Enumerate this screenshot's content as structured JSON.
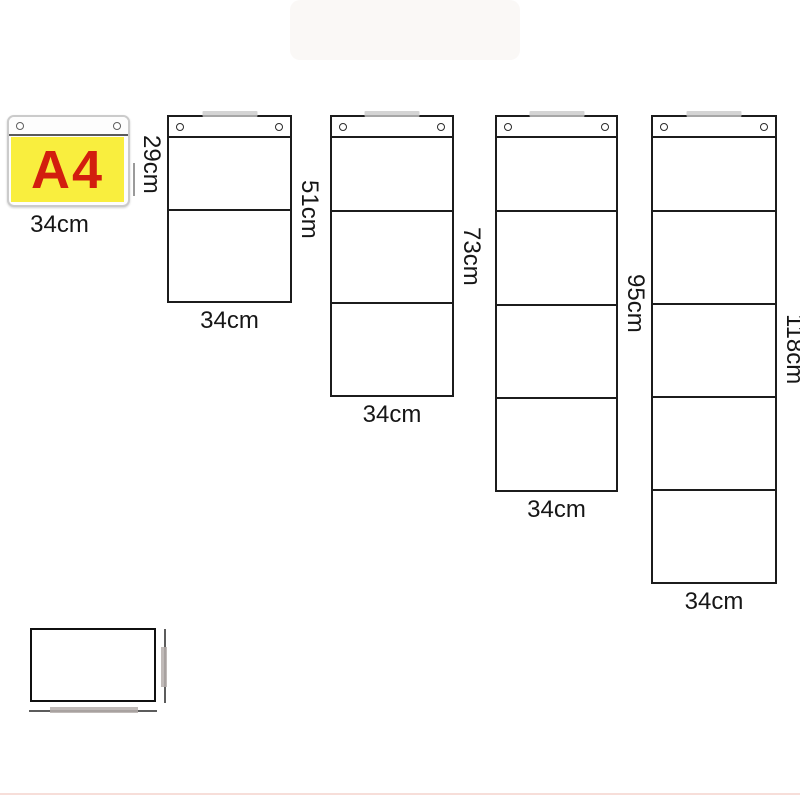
{
  "figure": {
    "panels": [
      {
        "pockets": 1,
        "insert_text": "A4",
        "width_label": "34cm",
        "height_label": "29cm"
      },
      {
        "pockets": 2,
        "width_label": "34cm",
        "height_label": "51cm"
      },
      {
        "pockets": 3,
        "width_label": "34cm",
        "height_label": "73cm"
      },
      {
        "pockets": 4,
        "width_label": "34cm",
        "height_label": "95cm"
      },
      {
        "pockets": 5,
        "width_label": "34cm",
        "height_label": "118cm"
      }
    ],
    "colors": {
      "outline": "#1c1c1c",
      "a4_insert_bg": "#f9ee3e",
      "a4_text": "#d21e0e",
      "a4_frame": "#cbcbcb",
      "hanging_tab": "#c9c9c9",
      "dimension_gray": "#b5aeac",
      "accent_bottom_line": "#f2cdc4"
    }
  }
}
